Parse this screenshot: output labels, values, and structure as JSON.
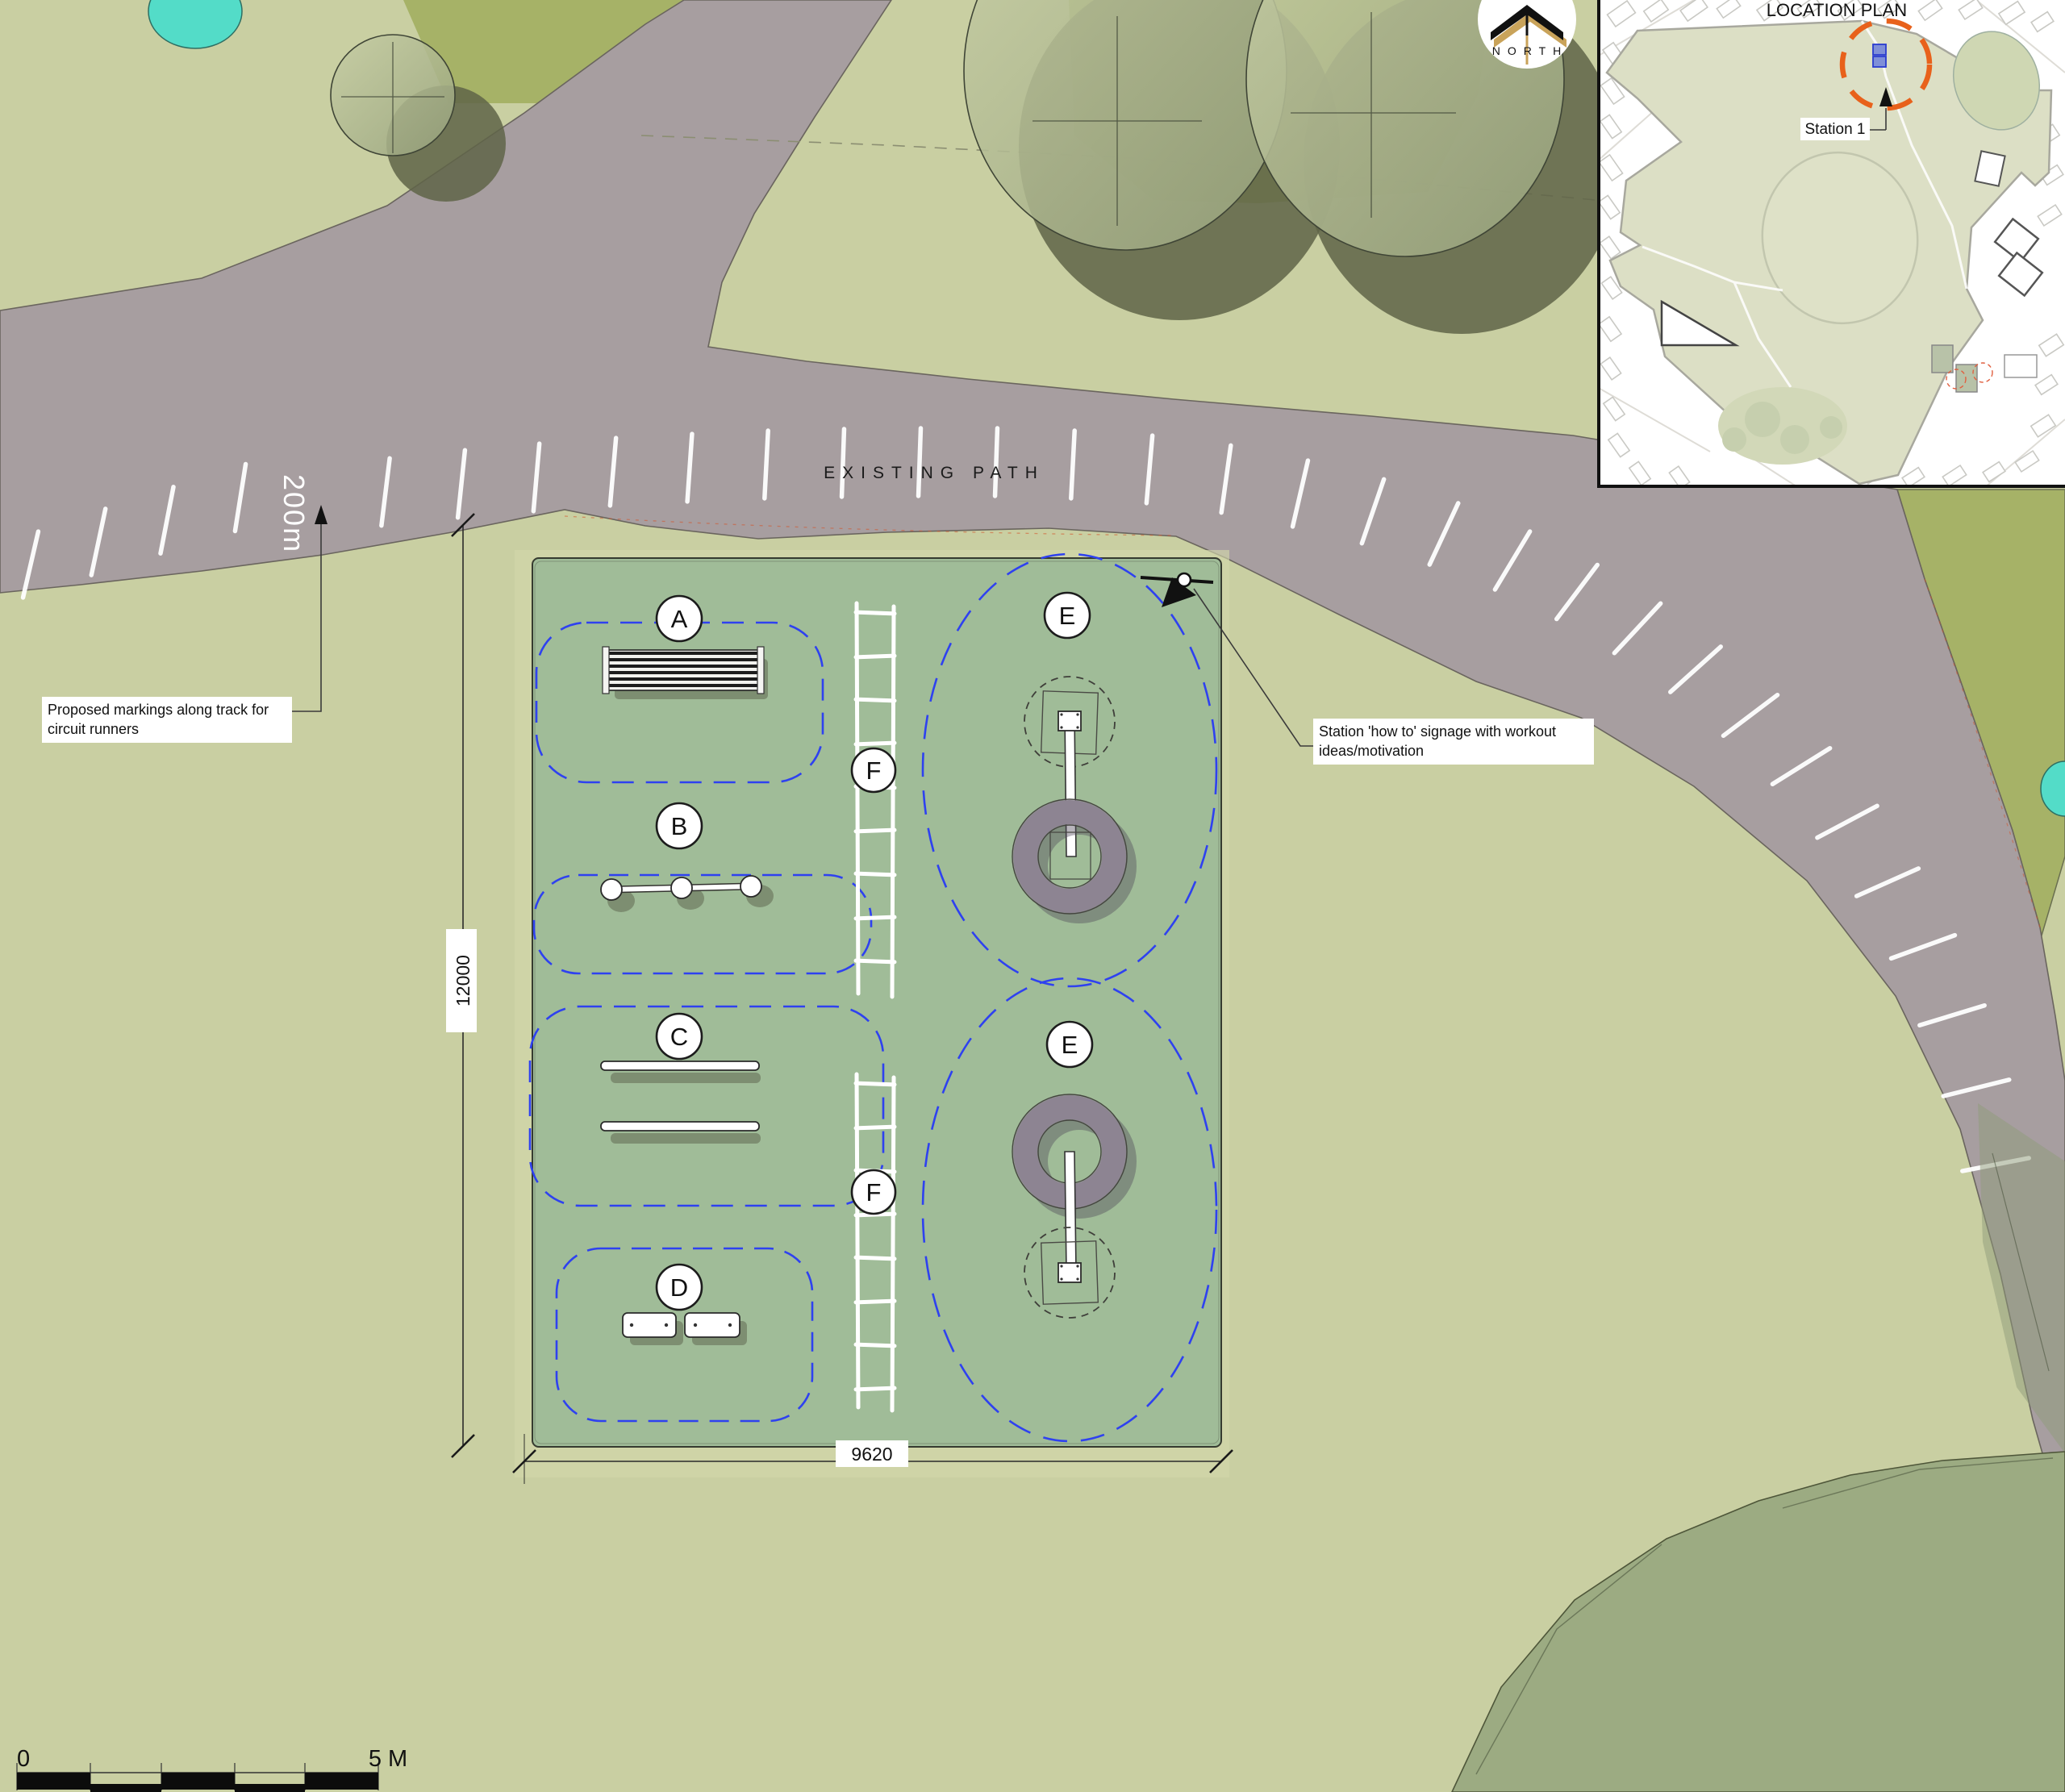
{
  "plan": {
    "existing_path_label": "EXISTING PATH",
    "track_distance_label": "200m",
    "stations": [
      {
        "id": "A"
      },
      {
        "id": "B"
      },
      {
        "id": "C"
      },
      {
        "id": "D"
      },
      {
        "id": "E"
      },
      {
        "id": "E"
      },
      {
        "id": "F"
      },
      {
        "id": "F"
      }
    ],
    "annotations": {
      "track_markings": "Proposed markings along track for circuit runners",
      "signage": "Station 'how to' signage with workout ideas/motivation"
    },
    "dimensions": {
      "vertical": "12000",
      "horizontal": "9620"
    }
  },
  "location_plan": {
    "title": "LOCATION PLAN",
    "station_label": "Station 1"
  },
  "compass": {
    "label": "NORTH"
  },
  "scale_bar": {
    "zero": "0",
    "max": "5 M"
  },
  "colors": {
    "background": "#c9cfa2",
    "workout_area": "#a0bc98",
    "path_gray": "#a79ea0",
    "dark_green": "#a6b267",
    "zone_blue": "#2e41f0",
    "highlight_orange": "#e8611b",
    "pond_teal": "#53dcc8",
    "north_gold": "#c9a35a",
    "ring_gray": "#8d8492",
    "canopy_green": "#9cab82"
  }
}
